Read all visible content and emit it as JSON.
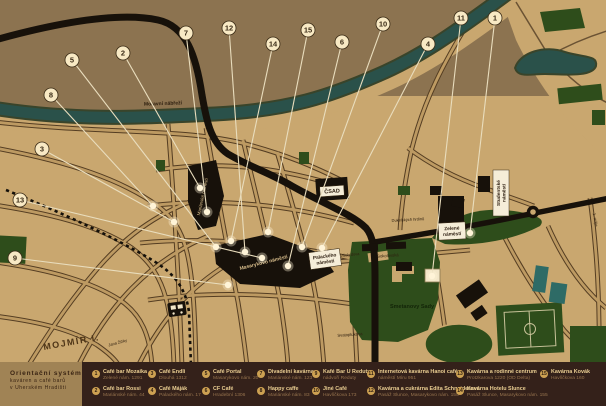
{
  "poster_title": {
    "line1": "Orientační systém",
    "line2": "kaváren a café barů",
    "line3": "v Uherském Hradišti"
  },
  "colors": {
    "background": "#8C7350",
    "city_blocks": "#C9A76F",
    "river": "#2A514A",
    "parks": "#2E4D1B",
    "roads_black": "#17110A",
    "marker_circle": "#F8E9C4",
    "leader_line": "#E9DDBD",
    "legend_bar": "#34211A",
    "title_panel": "#A08355",
    "legend_number_badge": "#CDA152",
    "legend_name_text": "#EACE92",
    "legend_address_text": "#97744E"
  },
  "legend": {
    "items": [
      {
        "num": "1",
        "name": "Café bar Mozaika",
        "address": "Zelené nám. 1291"
      },
      {
        "num": "2",
        "name": "Café bar Rossi",
        "address": "Mariánské nám. 44"
      },
      {
        "num": "3",
        "name": "Café Endli",
        "address": "Dlouhá 1312"
      },
      {
        "num": "4",
        "name": "Café Máják",
        "address": "Palackého nám. 17"
      },
      {
        "num": "5",
        "name": "Café Portal",
        "address": "Masarykovo nám. 20"
      },
      {
        "num": "6",
        "name": "CF Café",
        "address": "Hradební 1306"
      },
      {
        "num": "7",
        "name": "Divadelní kavárna",
        "address": "Mariánské nám. 123"
      },
      {
        "num": "8",
        "name": "Happy caffe",
        "address": "Mariánské nám. 83"
      },
      {
        "num": "9",
        "name": "Kafé Bar U Reduty",
        "address": "nádvoří Reduty"
      },
      {
        "num": "10",
        "name": "Jiné Café",
        "address": "Havlíčkova 173"
      },
      {
        "num": "11",
        "name": "Internetová kavárna Hanoi café",
        "address": "náměstí Míru 951"
      },
      {
        "num": "12",
        "name": "Kavárna a cukrárna Edita Schneiderová",
        "address": "Pasáž Slunce, Masarykovo nám. 155"
      },
      {
        "num": "13",
        "name": "Kavárna a rodinné centrum",
        "address": "Protzkarova 1220 (OD Delta)"
      },
      {
        "num": "14",
        "name": "Kavárna Hotelu Slunce",
        "address": "Pasáž Slunce, Masarykovo nám. 155"
      },
      {
        "num": "15",
        "name": "Kavárna Kovák",
        "address": "Havlíčkova 160"
      }
    ]
  },
  "map": {
    "markers": [
      {
        "num": "1",
        "cx": 495,
        "cy": 18,
        "ex": 470,
        "ey": 233
      },
      {
        "num": "2",
        "cx": 123,
        "cy": 53,
        "ex": 200,
        "ey": 188
      },
      {
        "num": "3",
        "cx": 42,
        "cy": 149,
        "ex": 174,
        "ey": 222
      },
      {
        "num": "4",
        "cx": 428,
        "cy": 44,
        "ex": 322,
        "ey": 248
      },
      {
        "num": "5",
        "cx": 72,
        "cy": 60,
        "ex": 216,
        "ey": 247
      },
      {
        "num": "6",
        "cx": 342,
        "cy": 42,
        "ex": 288,
        "ey": 266
      },
      {
        "num": "7",
        "cx": 186,
        "cy": 33,
        "ex": 207,
        "ey": 212
      },
      {
        "num": "8",
        "cx": 51,
        "cy": 95,
        "ex": 153,
        "ey": 206
      },
      {
        "num": "9",
        "cx": 15,
        "cy": 258,
        "ex": 228,
        "ey": 285
      },
      {
        "num": "10",
        "cx": 383,
        "cy": 24,
        "ex": 302,
        "ey": 247
      },
      {
        "num": "11",
        "cx": 461,
        "cy": 18,
        "ex": 432,
        "ey": 276
      },
      {
        "num": "12",
        "cx": 229,
        "cy": 28,
        "ex": 245,
        "ey": 252
      },
      {
        "num": "13",
        "cx": 20,
        "cy": 200,
        "ex": 262,
        "ey": 258
      },
      {
        "num": "14",
        "cx": 273,
        "cy": 44,
        "ex": 231,
        "ey": 241
      },
      {
        "num": "15",
        "cx": 308,
        "cy": 30,
        "ex": 268,
        "ey": 232
      }
    ],
    "street_labels": [
      {
        "t": "Moravní nábřeží",
        "x": 163,
        "y": 105,
        "s": 5,
        "r": -2,
        "c": "#2F2010",
        "w": "bold"
      },
      {
        "t": "MOJMÍR I.",
        "x": 72,
        "y": 345,
        "s": 9,
        "r": -10,
        "c": "#4E3517",
        "w": "bold",
        "ls": 1.5
      },
      {
        "t": "Smetanovy Sady",
        "x": 412,
        "y": 308,
        "s": 5.5,
        "r": 0,
        "c": "#132508",
        "w": "bold"
      },
      {
        "t": "Sokolovská",
        "x": 388,
        "y": 257,
        "s": 4.2,
        "r": -4,
        "c": "#2F2010"
      },
      {
        "t": "Všehrdova",
        "x": 350,
        "y": 256,
        "s": 4,
        "r": -6,
        "c": "#2F2010"
      },
      {
        "t": "Dukelských hrdinů",
        "x": 408,
        "y": 221,
        "s": 4,
        "r": -3,
        "c": "#2F2010"
      },
      {
        "t": "Svatoplukova",
        "x": 350,
        "y": 336,
        "s": 4.2,
        "r": -4,
        "c": "#2F2010"
      },
      {
        "t": "Jana Žižky",
        "x": 118,
        "y": 344,
        "s": 4,
        "r": -15,
        "c": "#2F2010"
      },
      {
        "t": "1. máje",
        "x": 594,
        "y": 220,
        "s": 4.2,
        "r": 80,
        "c": "#2F2010"
      },
      {
        "t": "Mariánské náměstí",
        "x": 204,
        "y": 197,
        "s": 4.5,
        "r": -78,
        "c": "#D8BD8B"
      },
      {
        "t": "Masarykovo náměstí",
        "x": 264,
        "y": 264,
        "s": 5,
        "r": -14,
        "c": "#D8BD8B",
        "w": "bold"
      }
    ],
    "boxed_labels": [
      {
        "lines": [
          "ČSAD"
        ],
        "x": 332,
        "y": 191,
        "w": 24,
        "h": 10,
        "r": -4,
        "s": 5.5
      },
      {
        "lines": [
          "Zelené",
          "náměstí"
        ],
        "x": 452,
        "y": 231,
        "w": 27,
        "h": 17,
        "r": -3,
        "s": 4.8
      },
      {
        "lines": [
          "Palackého",
          "náměstí"
        ],
        "x": 325,
        "y": 259,
        "w": 31,
        "h": 17,
        "r": -8,
        "s": 4.8
      },
      {
        "lines": [
          "Studentské",
          "náměstí"
        ],
        "x": 501,
        "y": 193,
        "w": 46,
        "h": 16,
        "r": -90,
        "s": 4.8
      }
    ]
  }
}
